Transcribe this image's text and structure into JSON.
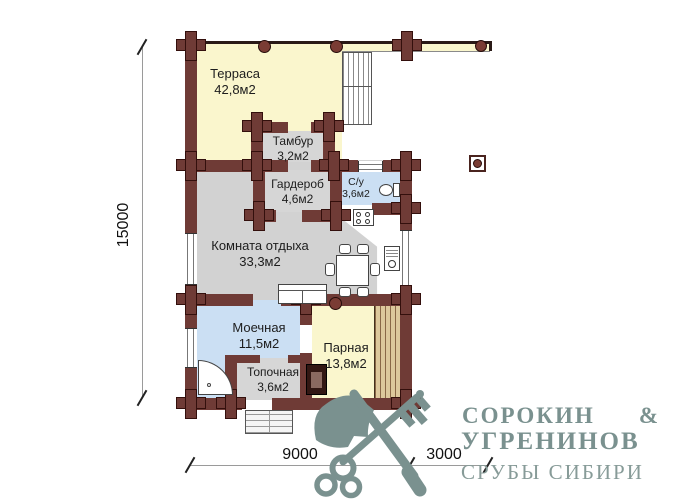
{
  "plan": {
    "rooms": [
      {
        "name": "Терраса",
        "area": "42,8м2"
      },
      {
        "name": "Тамбур",
        "area": "3,2м2"
      },
      {
        "name": "Гардероб",
        "area": "4,6м2"
      },
      {
        "name": "С/у",
        "area": "3,6м2"
      },
      {
        "name": "Комната отдыха",
        "area": "33,3м2"
      },
      {
        "name": "Моечная",
        "area": "11,5м2"
      },
      {
        "name": "Парная",
        "area": "13,8м2"
      },
      {
        "name": "Топочная",
        "area": "3,6м2"
      }
    ],
    "dimensions": {
      "height": "15000",
      "width_main": "9000",
      "width_terrace": "3000"
    }
  },
  "logo": {
    "partner1": "СОРОКИН",
    "ampersand": "&",
    "partner2": "УГРЕНИНОВ",
    "tagline": "СРУБЫ СИБИРИ"
  },
  "icons": {
    "logo": "crossed-axe-and-key-icon",
    "furniture": [
      "toilet-icon",
      "shower-icon",
      "kitchen-stove-icon",
      "sink-icon",
      "dining-table",
      "sofa",
      "sauna-heater-icon",
      "stairs",
      "entrance-steps"
    ]
  },
  "colors": {
    "wall": "#6F3B36",
    "terrace_yellow": "#FAF6CD",
    "dry_room_gray": "#D4D4D4",
    "wet_room_blue": "#CBDFF3",
    "bench_wood": "#DDC89C",
    "logo_teal": "#7A918F"
  }
}
